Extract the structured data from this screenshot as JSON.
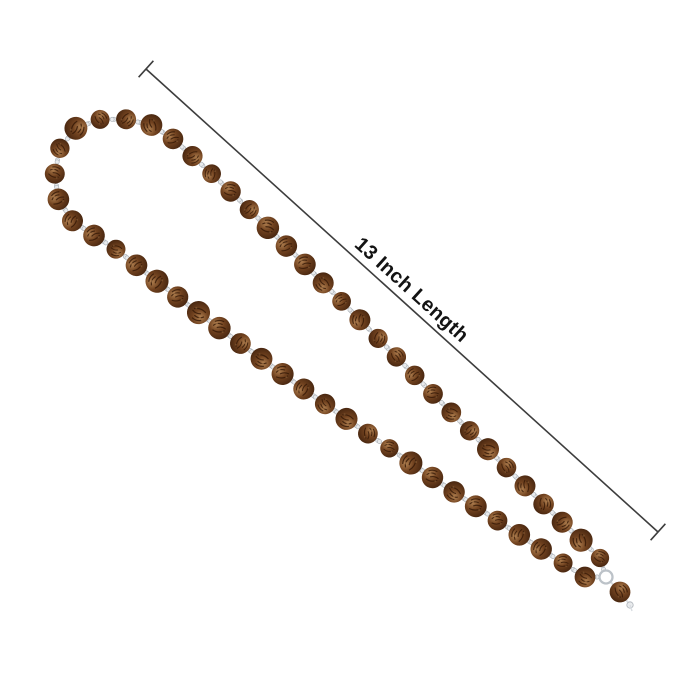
{
  "page": {
    "background_color": "#ffffff",
    "width": 700,
    "height": 700,
    "kind": "product-photo"
  },
  "annotation": {
    "label": "13 Inch Length",
    "text_color": "#131313",
    "font_size": 20,
    "line_color": "#3d3d3d",
    "line_width": 1.6,
    "line": {
      "x1": 146,
      "y1": 69,
      "x2": 658,
      "y2": 532
    },
    "end_cap_length": 22,
    "label_perp_offset": -8
  },
  "necklace": {
    "type": "rudraksha-bead-mala",
    "bead_count": 56,
    "bead_radius": 10.4,
    "bead_colors": {
      "highlight": "#b08050",
      "mid": "#71421f",
      "dark": "#46250f",
      "crevice": "#331806"
    },
    "link_color": "#d9dde1",
    "cap_fill": "#e9ebed",
    "cap_stroke": "#aeb4ba",
    "ring_color": "#bcc2c8",
    "loop_path": "M 600 558 C 450 418 260 210 160 128 C 112 110 72 118 60 148 C 50 175 54 206 74 222 C 86 231 96 237 112 246 C 255 360 440 485 585 577",
    "junction": {
      "ring": {
        "x": 606,
        "y": 577,
        "r": 6.5
      },
      "guru_bead": {
        "x": 620,
        "y": 592
      },
      "drop": {
        "x": 630,
        "y": 605,
        "r": 3.2
      }
    }
  }
}
